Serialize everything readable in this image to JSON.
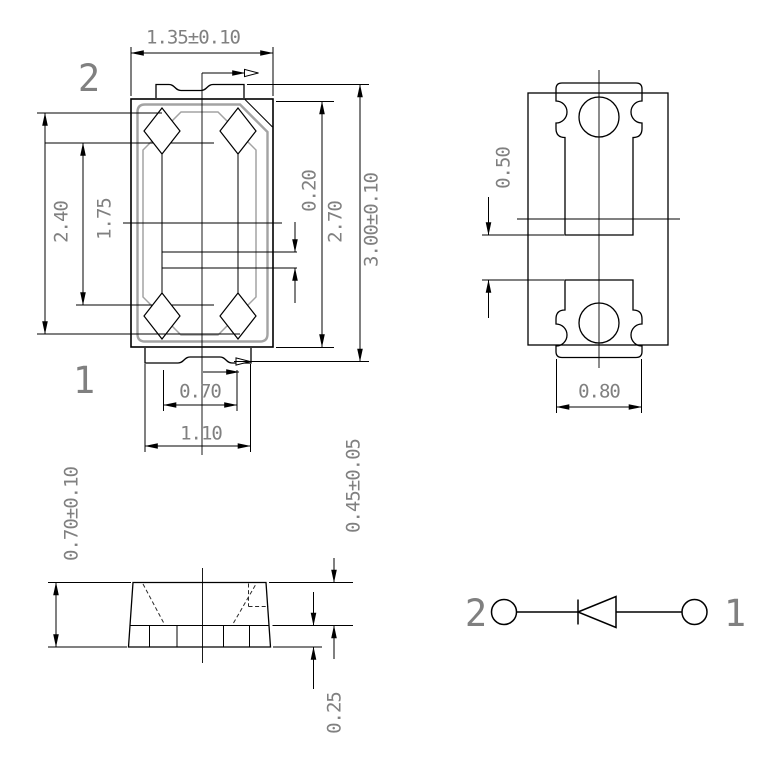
{
  "colors": {
    "background": "#ffffff",
    "line": "#000000",
    "secondary_line": "#a3a3a3",
    "dimension_text": "#808080"
  },
  "top_view": {
    "pin_2_label": "2",
    "pin_1_label": "1",
    "dim_body_width": "1.35±0.10",
    "dim_overall_length": "3.00±0.10",
    "dim_body_length": "2.70",
    "dim_inner_step": "0.20",
    "dim_cavity_length": "2.40",
    "dim_cavity_inner_length": "1.75",
    "dim_notch_width": "0.70",
    "dim_tab_width": "1.10"
  },
  "pad_layout_view": {
    "dim_pad_gap": "0.50",
    "dim_pad_width": "0.80"
  },
  "side_view": {
    "dim_total_height": "0.70±0.10",
    "dim_top_height": "0.45±0.05",
    "dim_base_height": "0.25"
  },
  "circuit_view": {
    "pin_2_label": "2",
    "pin_1_label": "1"
  }
}
